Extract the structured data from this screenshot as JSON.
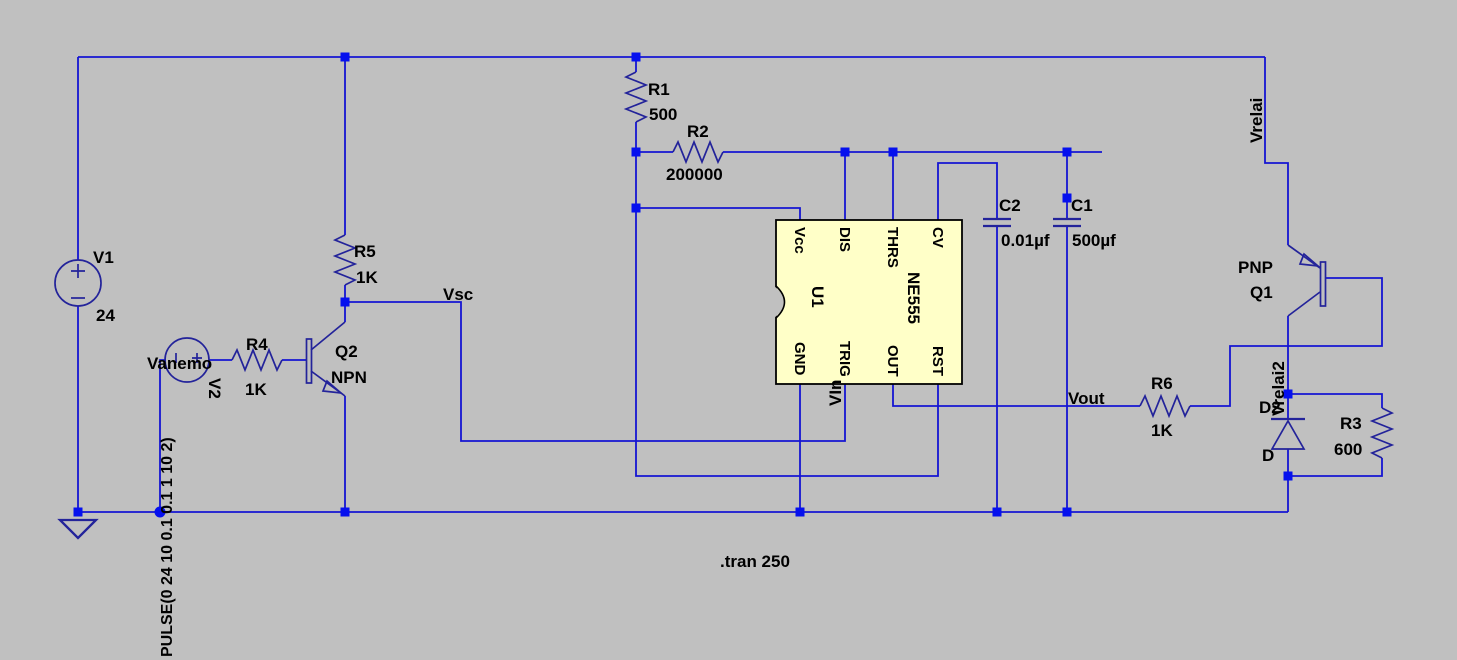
{
  "colors": {
    "background": "#c0c0c0",
    "wire": "#1414d2",
    "symbol": "#23239a",
    "junction": "#0510ee",
    "ic_fill": "#ffffc8",
    "ic_border": "#000000",
    "text": "#000000"
  },
  "labels": {
    "v1_name": "V1",
    "v1_value": "24",
    "v2_net": "Vanemo",
    "v2_name": "V2",
    "v2_pulse": "PULSE(0 24 10 0.1 0.1 1 10 2)",
    "r1_name": "R1",
    "r1_value": "500",
    "r2_name": "R2",
    "r2_value": "200000",
    "r3_name": "R3",
    "r3_value": "600",
    "r4_name": "R4",
    "r4_value": "1K",
    "r5_name": "R5",
    "r5_value": "1K",
    "r6_name": "R6",
    "r6_value": "1K",
    "c1_name": "C1",
    "c1_value": "500µf",
    "c2_name": "C2",
    "c2_value": "0.01µf",
    "q2_name": "Q2",
    "q2_type": "NPN",
    "q1_type": "PNP",
    "q1_name": "Q1",
    "d2_name": "D2",
    "d2_model": "D",
    "net_vsc": "Vsc",
    "net_vin": "VIn",
    "net_vout": "Vout",
    "net_vrelai": "Vrelai",
    "net_vrelai2": "Vrelai2",
    "directive": ".tran 250"
  },
  "ic": {
    "name": "U1",
    "part": "NE555",
    "pins_top": [
      "Vcc",
      "DIS",
      "THRS",
      "CV"
    ],
    "pins_bottom": [
      "GND",
      "TRIG",
      "OUT",
      "RST"
    ]
  }
}
